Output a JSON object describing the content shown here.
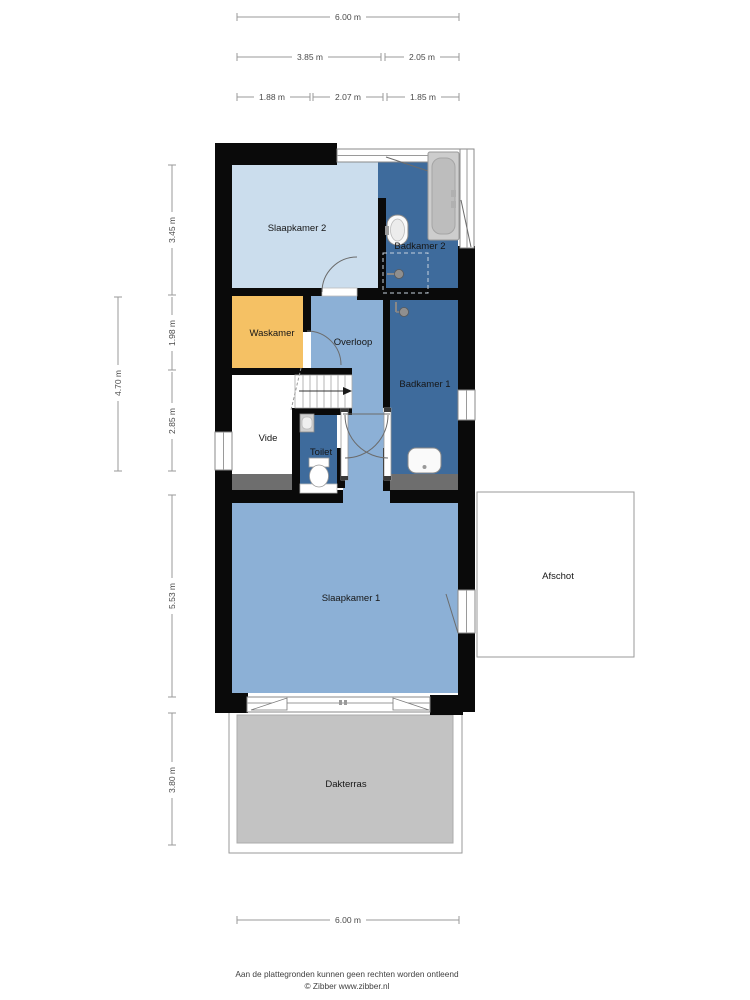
{
  "floorplan": {
    "wall_color": "#0a0a0a",
    "rooms": {
      "slaapkamer2": {
        "label": "Slaapkamer 2",
        "color": "#cbdded"
      },
      "badkamer2": {
        "label": "Badkamer 2",
        "color": "#3e6b9c"
      },
      "waskamer": {
        "label": "Waskamer",
        "color": "#f5c164"
      },
      "overloop": {
        "label": "Overloop",
        "color": "#8cb0d6"
      },
      "badkamer1": {
        "label": "Badkamer 1",
        "color": "#3e6b9c"
      },
      "vide": {
        "label": "Vide",
        "color": "#ffffff"
      },
      "toilet": {
        "label": "Toilet",
        "color": "#3e6b9c"
      },
      "slaapkamer1": {
        "label": "Slaapkamer 1",
        "color": "#8cb0d6"
      },
      "afschot": {
        "label": "Afschot",
        "color": "#ffffff"
      },
      "dakterras": {
        "label": "Dakterras",
        "color": "#c3c3c3"
      }
    }
  },
  "dimensions": {
    "top": {
      "total": "6.00 m",
      "row2_left": "3.85 m",
      "row2_right": "2.05 m",
      "row3_left": "1.88 m",
      "row3_mid": "2.07 m",
      "row3_right": "1.85 m"
    },
    "left": {
      "outer": "4.70 m",
      "seg1": "3.45 m",
      "seg2": "1.98 m",
      "seg3": "2.85 m",
      "seg4": "5.53 m",
      "seg5": "3.80 m"
    },
    "bottom": {
      "total": "6.00 m"
    }
  },
  "footer": {
    "disclaimer": "Aan de plattegronden kunnen geen rechten worden ontleend",
    "credit": "© Zibber www.zibber.nl"
  }
}
